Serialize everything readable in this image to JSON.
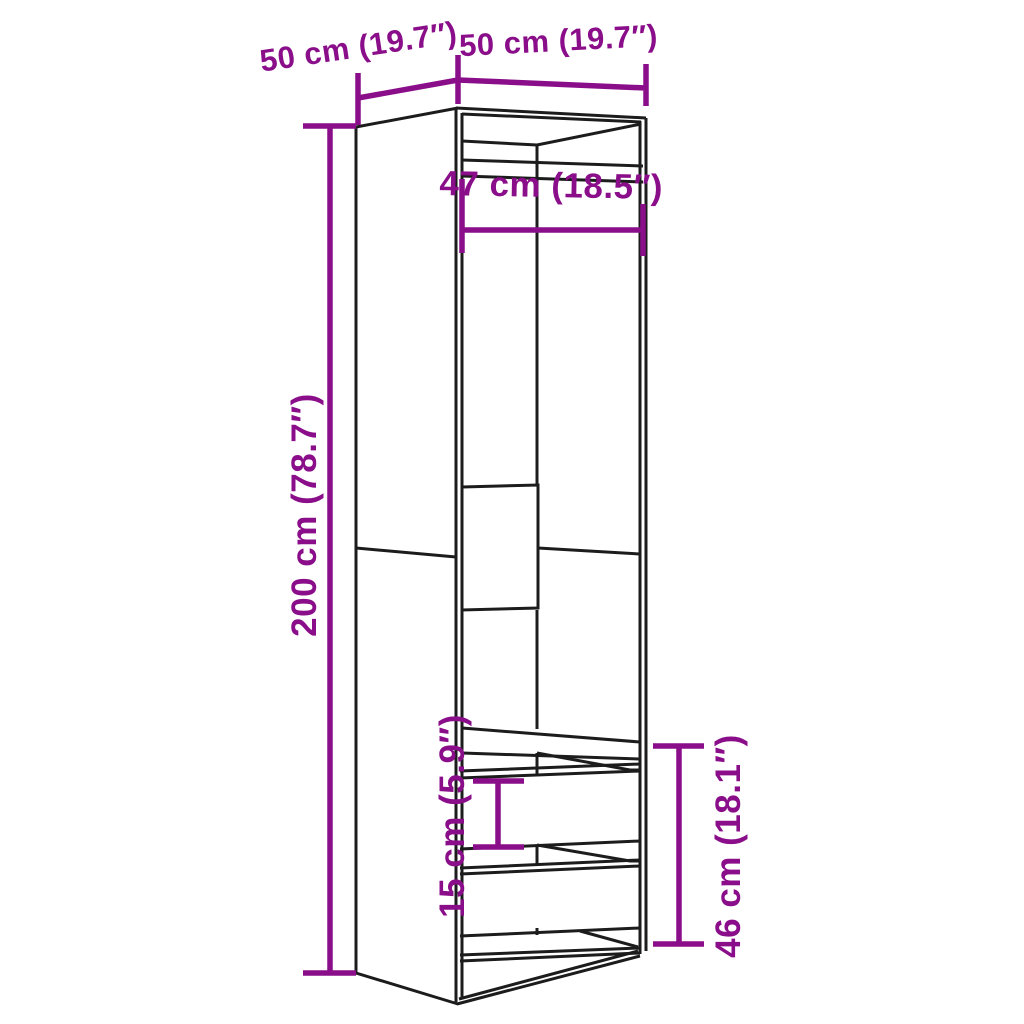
{
  "diagram": {
    "type": "furniture-dimension-line-drawing",
    "labels": {
      "depth": "50 cm (19.7″)",
      "width": "50 cm (19.7″)",
      "interior_width": "47 cm (18.5″)",
      "height": "200 cm (78.7″)",
      "drawer_height": "15 cm (5.9″)",
      "lower_section_height": "46 cm (18.1″)"
    },
    "colors": {
      "dimension_accent": "#8A0E8A",
      "line": "#1C1C1C",
      "background": "#FFFFFF"
    }
  }
}
